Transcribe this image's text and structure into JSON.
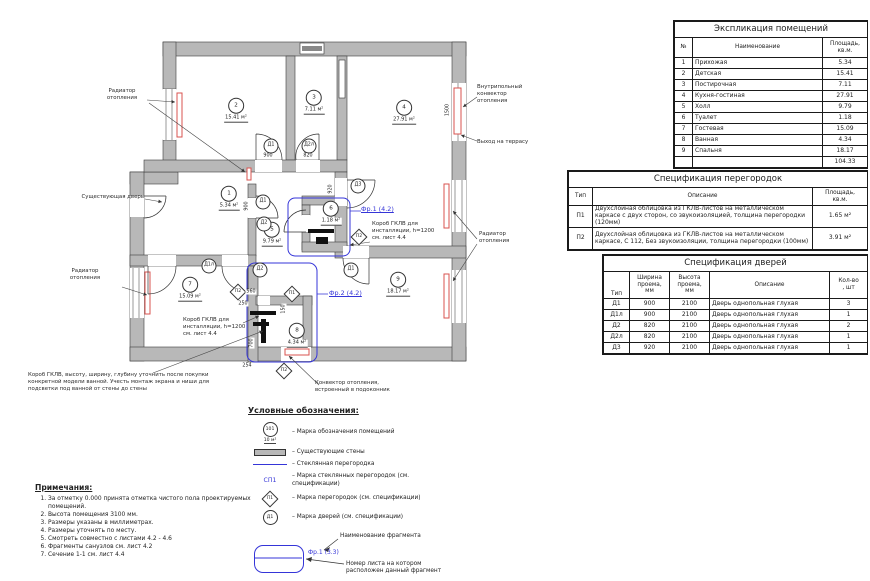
{
  "colors": {
    "accent_blue": "#3535d8",
    "radiator_red": "#d9534f",
    "wall_gray": "#b8b8b8"
  },
  "plan": {
    "rooms": [
      {
        "num": "1",
        "area": "5.34 м²",
        "x": 229,
        "y": 196
      },
      {
        "num": "2",
        "area": "15.41 м²",
        "x": 236,
        "y": 108
      },
      {
        "num": "3",
        "area": "7.11 м²",
        "x": 314,
        "y": 100
      },
      {
        "num": "4",
        "area": "27.91 м²",
        "x": 404,
        "y": 110
      },
      {
        "num": "5",
        "area": "9.79 м²",
        "x": 272,
        "y": 232
      },
      {
        "num": "6",
        "area": "1.18 м²",
        "x": 331,
        "y": 211
      },
      {
        "num": "7",
        "area": "15.09 м²",
        "x": 190,
        "y": 287
      },
      {
        "num": "8",
        "area": "4.34 м²",
        "x": 297,
        "y": 333
      },
      {
        "num": "9",
        "area": "18.17 м²",
        "x": 398,
        "y": 282
      }
    ],
    "door_marks": [
      {
        "label": "Д1",
        "x": 271,
        "y": 146
      },
      {
        "label": "Д2л",
        "x": 309,
        "y": 146
      },
      {
        "label": "Д3",
        "x": 358,
        "y": 186
      },
      {
        "label": "Д1",
        "x": 263,
        "y": 202
      },
      {
        "label": "Д2",
        "x": 264,
        "y": 224
      },
      {
        "label": "Д1л",
        "x": 209,
        "y": 266
      },
      {
        "label": "Д2",
        "x": 260,
        "y": 270
      },
      {
        "label": "Д1",
        "x": 351,
        "y": 270
      }
    ],
    "partition_marks": [
      {
        "label": "П2",
        "x": 359,
        "y": 237
      },
      {
        "label": "П2",
        "x": 238,
        "y": 292
      },
      {
        "label": "П1",
        "x": 292,
        "y": 294
      },
      {
        "label": "П2",
        "x": 284,
        "y": 371
      }
    ],
    "dimensions": [
      {
        "text": "900",
        "x": 268,
        "y": 156,
        "rot": 0
      },
      {
        "text": "820",
        "x": 308,
        "y": 156,
        "rot": 0
      },
      {
        "text": "920",
        "x": 331,
        "y": 189,
        "rot": 90
      },
      {
        "text": "900",
        "x": 247,
        "y": 206,
        "rot": 90
      },
      {
        "text": "1500",
        "x": 448,
        "y": 110,
        "rot": 90
      },
      {
        "text": "560",
        "x": 251,
        "y": 292,
        "rot": 0
      },
      {
        "text": "250",
        "x": 243,
        "y": 304,
        "rot": 0
      },
      {
        "text": "150",
        "x": 284,
        "y": 309,
        "rot": 90
      },
      {
        "text": "700",
        "x": 252,
        "y": 343,
        "rot": 90
      },
      {
        "text": "254",
        "x": 247,
        "y": 366,
        "rot": 0
      }
    ],
    "fragments": [
      {
        "label": "Фр.1 (4.2)",
        "x": 361,
        "y": 209
      },
      {
        "label": "Фр.2 (4.2)",
        "x": 329,
        "y": 293
      }
    ],
    "annotations": [
      {
        "text": "Радиатор\nотопления",
        "x": 95,
        "y": 88,
        "w": 54,
        "align": "center"
      },
      {
        "text": "Существующая дверь",
        "x": 56,
        "y": 194,
        "w": 88,
        "align": "right"
      },
      {
        "text": "Радиатор\nотопления",
        "x": 58,
        "y": 268,
        "w": 54,
        "align": "center"
      },
      {
        "text": "Внутрипольный\nконвектор\nотопления",
        "x": 477,
        "y": 84,
        "w": 66,
        "align": "left"
      },
      {
        "text": "Выход на террасу",
        "x": 477,
        "y": 139,
        "w": 82,
        "align": "left"
      },
      {
        "text": "Радиатор\nотопления",
        "x": 479,
        "y": 231,
        "w": 54,
        "align": "left"
      },
      {
        "text": "Короб ГКЛВ для\nинсталляции, h=1200\nсм. лист 4.4",
        "x": 372,
        "y": 221,
        "w": 84,
        "align": "left"
      },
      {
        "text": "Короб ГКЛВ для\nинсталляции, h=1200\nсм. лист 4.4",
        "x": 183,
        "y": 317,
        "w": 84,
        "align": "left"
      },
      {
        "text": "Короб ГКЛВ, высоту, ширину, глубину уточнить после покупки\nконкретной модели ванной. Учесть монтаж экрана и ниши для\nподсветки под ванной от стены до стены",
        "x": 28,
        "y": 372,
        "w": 238,
        "align": "left"
      },
      {
        "text": "Конвектор отопления,\nвстроенный в подоконник",
        "x": 315,
        "y": 380,
        "w": 118,
        "align": "left"
      }
    ]
  },
  "tables": {
    "rooms": {
      "title": "Экспликация помещений",
      "col_num": "№",
      "col_name": "Наименование",
      "col_area": "Площадь,\nкв.м.",
      "rows": [
        [
          "1",
          "Прихожая",
          "5.34"
        ],
        [
          "2",
          "Детская",
          "15.41"
        ],
        [
          "3",
          "Постирочная",
          "7.11"
        ],
        [
          "4",
          "Кухня-гостиная",
          "27.91"
        ],
        [
          "5",
          "Холл",
          "9.79"
        ],
        [
          "6",
          "Туалет",
          "1.18"
        ],
        [
          "7",
          "Гостевая",
          "15.09"
        ],
        [
          "8",
          "Ванная",
          "4.34"
        ],
        [
          "9",
          "Спальня",
          "18.17"
        ]
      ],
      "total": "104.33"
    },
    "partitions": {
      "title": "Спецификация перегородок",
      "col_type": "Тип",
      "col_desc": "Описание",
      "col_area": "Площадь,\nкв.м.",
      "rows": [
        [
          "П1",
          "Двухслойная облицовка из ГКЛВ-листов на металлическом каркасе с двух сторон, со звукоизоляцией, толщина перегородки (120мм)",
          "1.65 м²"
        ],
        [
          "П2",
          "Двухслойная облицовка из ГКЛВ-листов на металлическом каркасе, С 112, Без звукоизоляции, толщина перегородки (100мм)",
          "3.91 м²"
        ]
      ]
    },
    "doors": {
      "title": "Спецификация дверей",
      "col_type": "Тип",
      "col_width": "Ширина\nпроема,\nмм",
      "col_height": "Высота\nпроема,\nмм",
      "col_desc": "Описание",
      "col_qty": "Кол-во\n, шт",
      "rows": [
        [
          "Д1",
          "900",
          "2100",
          "Дверь однопольная глухая",
          "3"
        ],
        [
          "Д1л",
          "900",
          "2100",
          "Дверь однопольная глухая",
          "1"
        ],
        [
          "Д2",
          "820",
          "2100",
          "Дверь однопольная глухая",
          "2"
        ],
        [
          "Д2л",
          "820",
          "2100",
          "Дверь однопольная глухая",
          "1"
        ],
        [
          "Д3",
          "920",
          "2100",
          "Дверь однопольная глухая",
          "1"
        ]
      ]
    }
  },
  "legend": {
    "title": "Условные обозначения:",
    "room_mark_top": "101",
    "room_mark_bottom": "10 м²",
    "sp1": "СП1",
    "p1": "П1",
    "d1": "Д1",
    "items": [
      "– Марка обозначения помещений",
      "– Существующие стены",
      "– Стеклянная перегородка",
      "– Марка стеклянных перегородок (см. спецификации)",
      "– Марка перегородок (см. спецификации)",
      "– Марка дверей (см. спецификации)"
    ],
    "fragment_label": "Фр.1 (3.3)",
    "fragment_name": "Наименование фрагмента",
    "fragment_sheet": "Номер листа на котором расположен данный фрагмент"
  },
  "notes": {
    "title": "Примечания:",
    "items": [
      "За отметку 0.000 принята отметка чистого пола проектируемых помещений.",
      "Высота помещения 3100 мм.",
      "Размеры указаны в миллиметрах.",
      "Размеры уточнять по месту.",
      "Смотреть совместно с листами 4.2 - 4.6",
      "Фрагменты санузлов см. лист 4.2",
      "Сечение 1-1 см. лист 4.4"
    ]
  }
}
